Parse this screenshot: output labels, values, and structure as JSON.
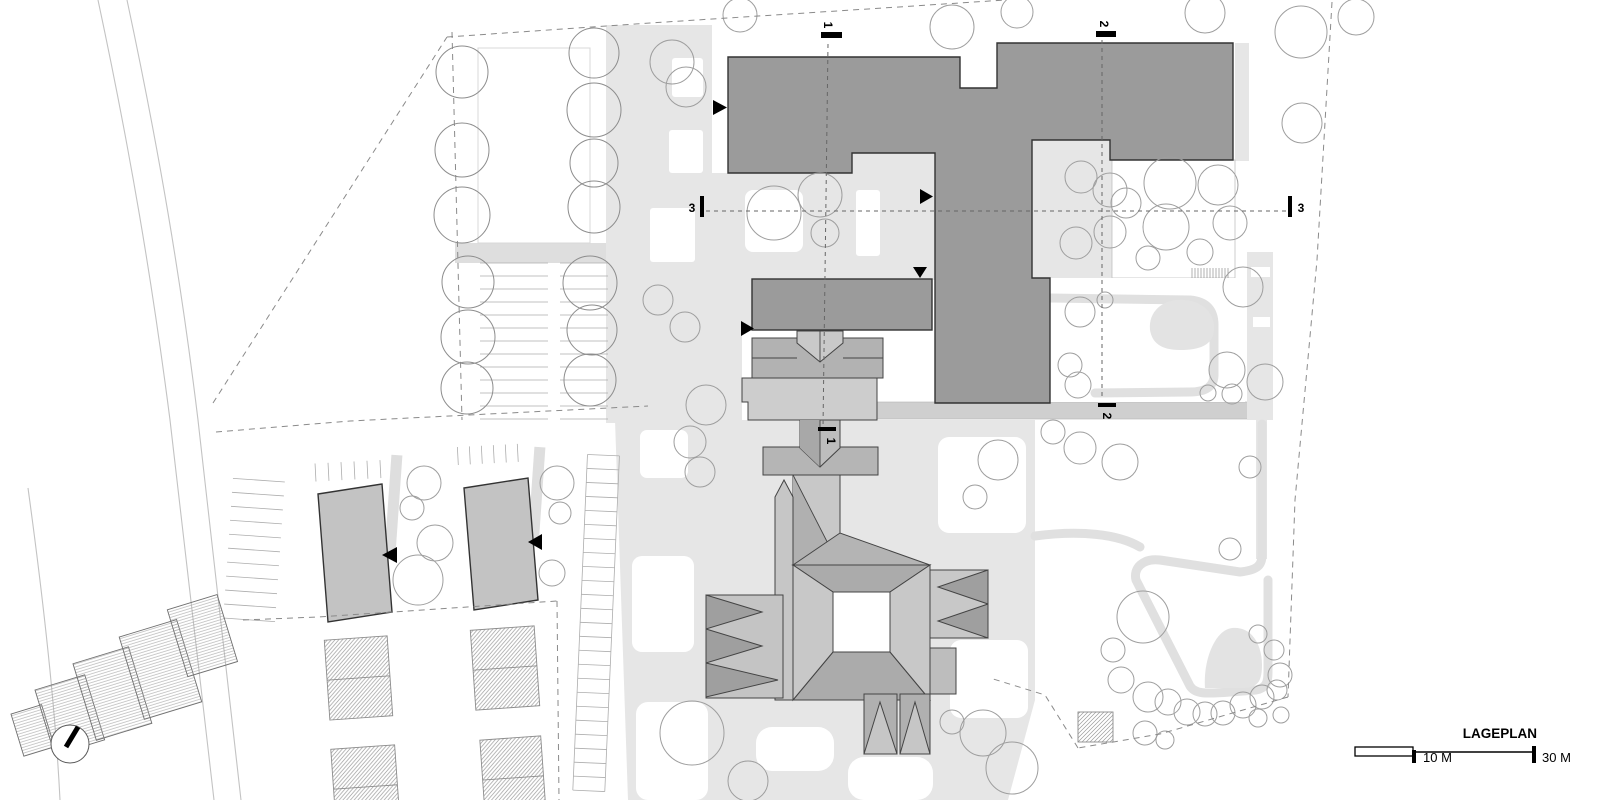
{
  "plan": {
    "title": "LAGEPLAN",
    "scale_bar": {
      "label_mid": "10 M",
      "label_end": "30 M"
    },
    "section_markers": {
      "one": "1",
      "two": "2",
      "three": "3"
    },
    "colors": {
      "building_dark": "#9b9b9b",
      "building_mid": "#b2b2b2",
      "roof_light": "#c9c9c9",
      "roof_shadow": "#a3a3a3",
      "residential": "#c3c3c3",
      "paving": "#e6e6e6",
      "path": "#cfcfcf",
      "tree_outline": "#9e9e9e",
      "outline_dark": "#333333",
      "marker_black": "#000000",
      "boundary_dash": "#8a8a8a"
    }
  }
}
